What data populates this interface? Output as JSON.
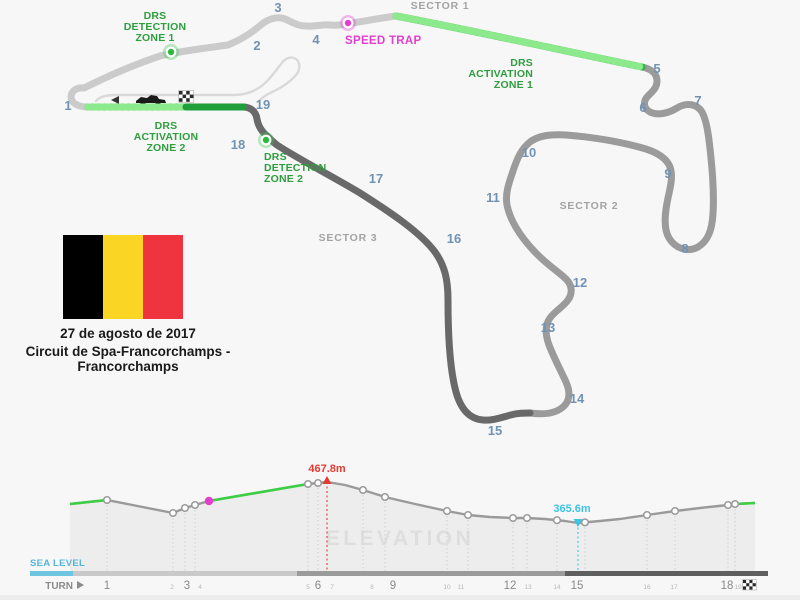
{
  "page": {
    "bg": "#f7f7f7",
    "footer_bg": "#ececec"
  },
  "map": {
    "colors": {
      "sector1_track": "#cbcbcb",
      "sector2_track": "#9b9b9b",
      "sector3_track": "#696969",
      "pit_lane": "#d9d9d9",
      "drs_green": "#2db53d",
      "drs_green_light": "#8ce98c",
      "drs_green_dark": "#1f9e3a",
      "label_green": "#2f9e3f",
      "magenta": "#e23fd0",
      "turn_number": "#7093b5",
      "sector_label": "#a3a3a3"
    },
    "sector_labels": [
      {
        "text": "SECTOR 1",
        "x": 440,
        "y": 9
      },
      {
        "text": "SECTOR 2",
        "x": 589,
        "y": 209
      },
      {
        "text": "SECTOR 3",
        "x": 348,
        "y": 241
      }
    ],
    "turn_numbers": [
      {
        "n": "1",
        "x": 68,
        "y": 110
      },
      {
        "n": "2",
        "x": 257,
        "y": 50
      },
      {
        "n": "3",
        "x": 278,
        "y": 12
      },
      {
        "n": "4",
        "x": 316,
        "y": 44
      },
      {
        "n": "5",
        "x": 657,
        "y": 73
      },
      {
        "n": "6",
        "x": 643,
        "y": 112
      },
      {
        "n": "7",
        "x": 698,
        "y": 105
      },
      {
        "n": "8",
        "x": 685,
        "y": 253
      },
      {
        "n": "9",
        "x": 668,
        "y": 178
      },
      {
        "n": "10",
        "x": 529,
        "y": 157
      },
      {
        "n": "11",
        "x": 493,
        "y": 202
      },
      {
        "n": "12",
        "x": 580,
        "y": 287
      },
      {
        "n": "13",
        "x": 548,
        "y": 332
      },
      {
        "n": "14",
        "x": 577,
        "y": 403
      },
      {
        "n": "15",
        "x": 495,
        "y": 435
      },
      {
        "n": "16",
        "x": 454,
        "y": 243
      },
      {
        "n": "17",
        "x": 376,
        "y": 183
      },
      {
        "n": "18",
        "x": 238,
        "y": 149
      },
      {
        "n": "19",
        "x": 263,
        "y": 109
      }
    ],
    "drs_labels": [
      {
        "name": "drs-detection-zone-1-label",
        "lines": [
          "DRS",
          "DETECTION",
          "ZONE 1"
        ],
        "x": 155,
        "y": 19,
        "anchor": "middle"
      },
      {
        "name": "drs-activation-zone-1-label",
        "lines": [
          "DRS",
          "ACTIVATION",
          "ZONE 1"
        ],
        "x": 533,
        "y": 66,
        "anchor": "end"
      },
      {
        "name": "drs-activation-zone-2-label",
        "lines": [
          "DRS",
          "ACTIVATION",
          "ZONE 2"
        ],
        "x": 166,
        "y": 129,
        "anchor": "middle"
      },
      {
        "name": "drs-detection-zone-2-label",
        "lines": [
          "DRS",
          "DETECTION",
          "ZONE 2"
        ],
        "x": 264,
        "y": 160,
        "anchor": "start"
      }
    ],
    "speed_trap_label": {
      "text": "SPEED TRAP",
      "x": 345,
      "y": 44
    },
    "markers": [
      {
        "name": "drs-detection-zone-1-marker",
        "x": 171,
        "y": 52,
        "type": "green"
      },
      {
        "name": "speed-trap-marker",
        "x": 348,
        "y": 23,
        "type": "magenta"
      },
      {
        "name": "drs-detection-zone-2-marker",
        "x": 266,
        "y": 140,
        "type": "green"
      }
    ],
    "pit_icons": [
      "left-arrow-icon",
      "f1-car-icon",
      "checkered-flag-icon"
    ]
  },
  "event": {
    "date": "27 de agosto de 2017",
    "circuit_name": "Circuit de Spa-Francorchamps - Francorchamps",
    "flag_name": "belgium-flag",
    "flag_colors": [
      "#000000",
      "#FBD523",
      "#EF333F"
    ]
  },
  "elevation": {
    "watermark": "ELEVATION",
    "sea_level_label": "SEA LEVEL",
    "axis_label": "TURN",
    "colors": {
      "line": "#9a9a9a",
      "fill": "#ededed",
      "green": "#3bcf44",
      "red": "#e23c32",
      "cyan": "#3fc3e3",
      "magenta": "#e23fd0",
      "sea_level": "#56b4d8",
      "sea_level_bar": "#6cc6e0",
      "bar_light": "#c9c9c9",
      "bar_mid": "#9b9b9b",
      "bar_dark": "#5f5f5f",
      "axis_major": "#8a8a8a",
      "axis_minor": "#b8b8b8",
      "watermark_color": "#dedede",
      "dotted": "#d0d0d0"
    },
    "chart_data": {
      "type": "area",
      "title": "ELEVATION",
      "max_point": {
        "label": "467.8m",
        "x": 327,
        "y": 482
      },
      "min_point": {
        "label": "365.6m",
        "x": 578,
        "y": 523
      },
      "profile_points": [
        [
          70,
          504
        ],
        [
          107,
          500
        ],
        [
          173,
          513
        ],
        [
          185,
          508
        ],
        [
          195,
          505
        ],
        [
          209,
          501
        ],
        [
          308,
          484
        ],
        [
          318,
          483
        ],
        [
          327,
          482
        ],
        [
          345,
          485
        ],
        [
          363,
          490
        ],
        [
          385,
          497
        ],
        [
          415,
          504
        ],
        [
          447,
          511
        ],
        [
          468,
          515
        ],
        [
          490,
          517
        ],
        [
          513,
          518
        ],
        [
          527,
          518
        ],
        [
          545,
          519
        ],
        [
          565,
          521
        ],
        [
          578,
          523
        ],
        [
          600,
          521
        ],
        [
          620,
          519
        ],
        [
          647,
          515
        ],
        [
          675,
          511
        ],
        [
          700,
          508
        ],
        [
          728,
          505
        ],
        [
          735,
          504
        ],
        [
          755,
          503
        ]
      ],
      "green_ranges": [
        [
          70,
          107
        ],
        [
          209,
          308
        ],
        [
          735,
          755
        ]
      ],
      "node_xs": [
        107,
        173,
        185,
        195,
        308,
        318,
        363,
        385,
        447,
        468,
        513,
        527,
        557,
        585,
        647,
        675,
        728,
        735
      ],
      "speed_trap_x": 209,
      "baseline_y": 573,
      "bar_segments": [
        {
          "x1": 30,
          "x2": 73,
          "color_key": "sea_level_bar"
        },
        {
          "x1": 73,
          "x2": 297,
          "color_key": "bar_light"
        },
        {
          "x1": 297,
          "x2": 565,
          "color_key": "bar_mid"
        },
        {
          "x1": 565,
          "x2": 768,
          "color_key": "bar_dark"
        }
      ],
      "axis_turns": [
        {
          "n": "1",
          "x": 107,
          "major": true
        },
        {
          "n": "2",
          "x": 172,
          "major": false
        },
        {
          "n": "3",
          "x": 187,
          "major": true
        },
        {
          "n": "4",
          "x": 200,
          "major": false
        },
        {
          "n": "5",
          "x": 308,
          "major": false
        },
        {
          "n": "6",
          "x": 318,
          "major": true
        },
        {
          "n": "7",
          "x": 332,
          "major": false
        },
        {
          "n": "8",
          "x": 372,
          "major": false
        },
        {
          "n": "9",
          "x": 393,
          "major": true
        },
        {
          "n": "10",
          "x": 447,
          "major": false
        },
        {
          "n": "11",
          "x": 461,
          "major": false
        },
        {
          "n": "12",
          "x": 510,
          "major": true
        },
        {
          "n": "13",
          "x": 528,
          "major": false
        },
        {
          "n": "14",
          "x": 557,
          "major": false
        },
        {
          "n": "15",
          "x": 577,
          "major": true
        },
        {
          "n": "16",
          "x": 647,
          "major": false
        },
        {
          "n": "17",
          "x": 674,
          "major": false
        },
        {
          "n": "18",
          "x": 727,
          "major": true
        },
        {
          "n": "19",
          "x": 738,
          "major": false
        }
      ]
    }
  }
}
